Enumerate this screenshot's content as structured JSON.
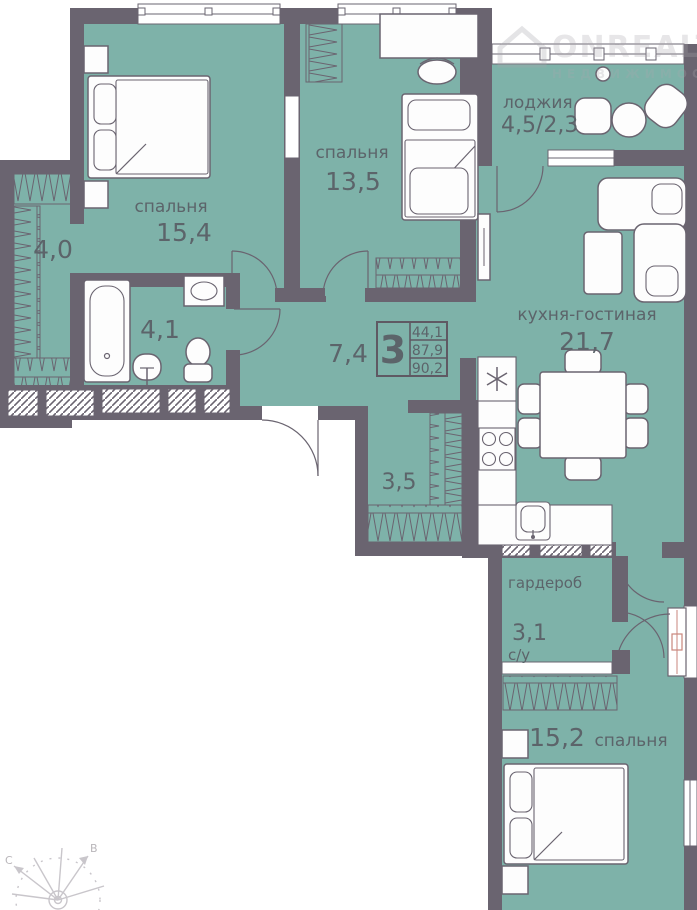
{
  "plan": {
    "type": "apartment-floor-plan",
    "info_box": {
      "rooms_count": "3",
      "living_area": "44,1",
      "area": "87,9",
      "total_area": "90,2"
    },
    "rooms": {
      "bedroom_top_left": {
        "label": "спальня",
        "area": "15,4"
      },
      "bedroom_top_mid": {
        "label": "спальня",
        "area": "13,5"
      },
      "bedroom_bottom": {
        "label": "спальня",
        "area": "15,2"
      },
      "loggia": {
        "label": "лоджия",
        "area": "4,5/2,3"
      },
      "kitchen_living": {
        "label": "кухня-гостиная",
        "area": "21,7"
      },
      "hallway": {
        "area": "7,4"
      },
      "hallway_small": {
        "area": "3,5"
      },
      "wardrobe_niche": {
        "area": "4,0"
      },
      "bathroom": {
        "area": "4,1"
      },
      "wardrobe": {
        "label": "гардероб",
        "area": "3,1"
      },
      "wc": {
        "label": "с/у"
      }
    },
    "compass": {
      "north": "С",
      "east": "В"
    },
    "watermark": {
      "brand": "ONREALT",
      "subtitle": "НЕДВИЖИМОСТЬ"
    },
    "colors": {
      "floor": "#7eb2a9",
      "wall": "#6a6470",
      "text": "#5c646a",
      "watermark": "#a7a6ab",
      "compass": "#c9c6cb",
      "door_accent": "#c9857c"
    }
  }
}
